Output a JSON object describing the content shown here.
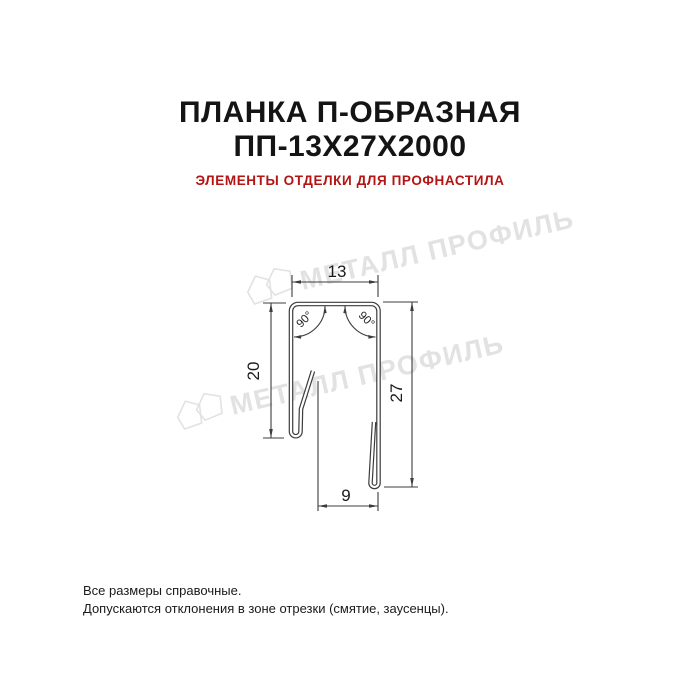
{
  "header": {
    "title_line1": "ПЛАНКА П-ОБРАЗНАЯ",
    "title_line2": "ПП-13Х27Х2000",
    "subtitle": "ЭЛЕМЕНТЫ ОТДЕЛКИ ДЛЯ ПРОФНАСТИЛА",
    "title_color": "#141414",
    "subtitle_color": "#b41414"
  },
  "drawing": {
    "type": "technical cross-section of U-shaped flashing strip",
    "dimensions": {
      "top_width": "13",
      "left_height": "20",
      "right_height": "27",
      "bottom_width": "9",
      "angle_left": "90°",
      "angle_right": "90°"
    },
    "line_color": "#3c3c3c"
  },
  "watermark": {
    "text": "МЕТАЛЛ ПРОФИЛЬ",
    "color": "#e2e2e2"
  },
  "footer": {
    "line1": "Все размеры справочные.",
    "line2": "Допускаются отклонения в зоне отрезки (смятие, заусенцы).",
    "color": "#1a1a1a"
  }
}
